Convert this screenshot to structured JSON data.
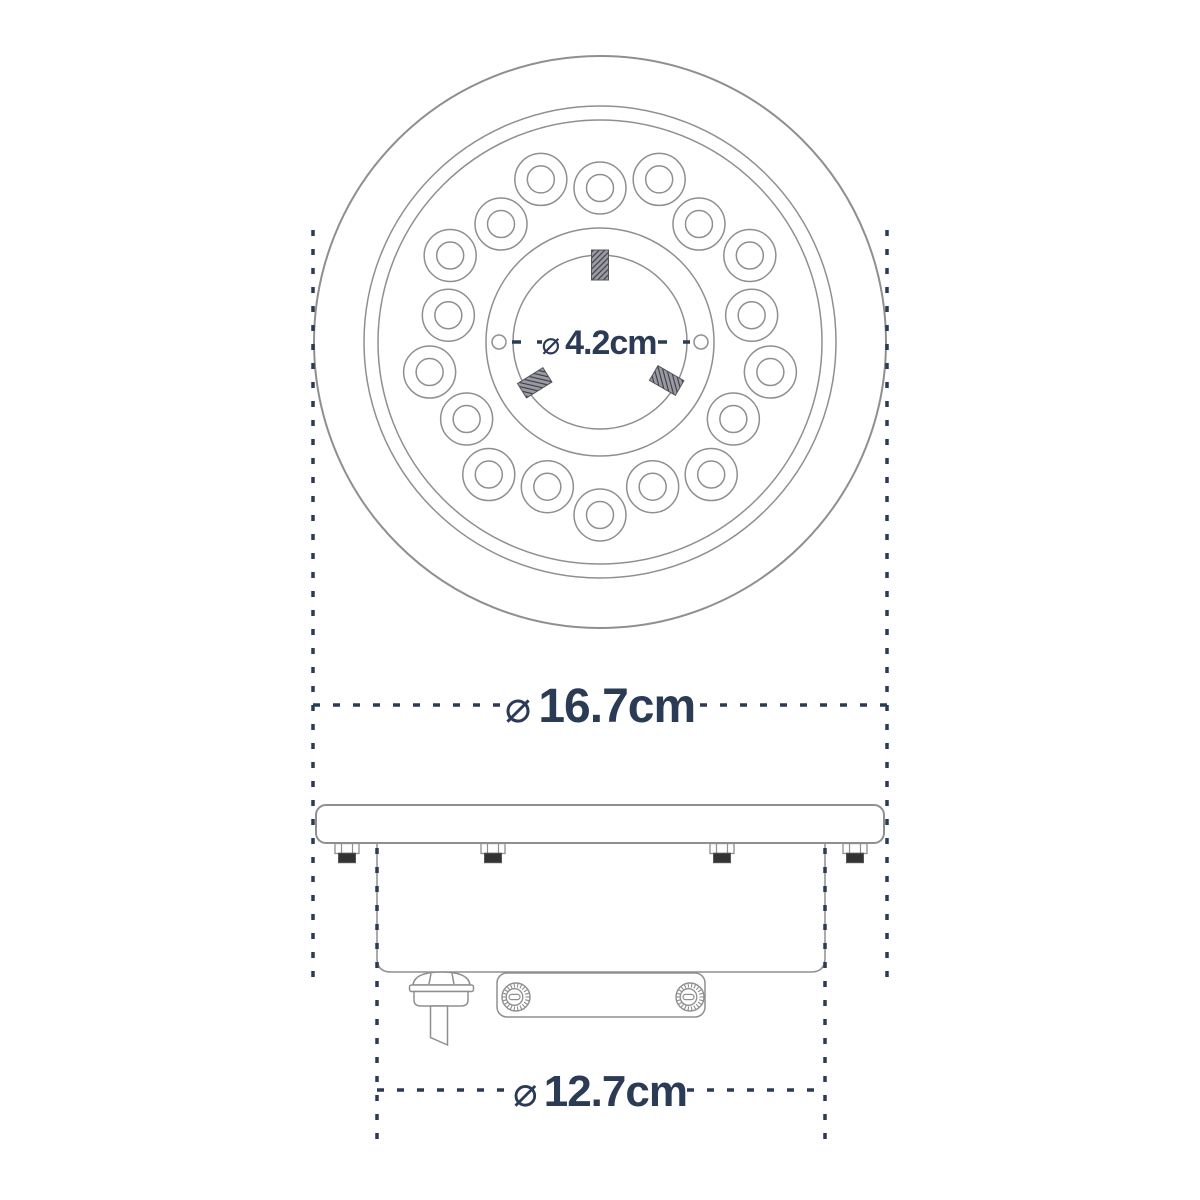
{
  "dimensions": {
    "center_hole": {
      "symbol": "⌀",
      "value": "4.2cm"
    },
    "outer": {
      "symbol": "⌀",
      "value": "16.7cm"
    },
    "body": {
      "symbol": "⌀",
      "value": "12.7cm"
    }
  },
  "colors": {
    "background": "#ffffff",
    "drawing_line": "#8f8f8f",
    "dimension_navy": "#2b3a55",
    "screw_dark": "#333333",
    "hatch_dark": "#3a3a42"
  },
  "top_view": {
    "center": [
      600,
      342
    ],
    "outer_circle_radii": [
      286,
      236,
      222
    ],
    "hub_outer_r": 114,
    "hub_inner_r": 87,
    "side_hole_ring_r": 101,
    "side_hole_r": 7,
    "led_count": 18,
    "led_start_angle_deg": 90,
    "led_angle_step_deg": 20,
    "led_ring_radii": [
      154,
      173
    ],
    "led_outer_r": 26,
    "led_inner_r": 13.5,
    "stud_angles_deg": [
      90,
      212,
      330
    ],
    "stud_mid_r": 77,
    "stud_w": 17,
    "stud_h": 30
  },
  "side_view": {
    "flange": {
      "x": 316,
      "y": 805,
      "w": 568,
      "h": 38,
      "rx": 10
    },
    "body": {
      "left": 377,
      "right": 825,
      "top": 843,
      "bottom": 972,
      "corner": 14
    },
    "flange_screw_x": [
      347,
      493,
      722,
      855
    ],
    "bracket": {
      "x": 497,
      "y": 973,
      "w": 208,
      "h": 44,
      "rx": 10
    },
    "bracket_screw_x": [
      516,
      690
    ],
    "bracket_screw_cy": 997,
    "bracket_screw_r": 14
  }
}
